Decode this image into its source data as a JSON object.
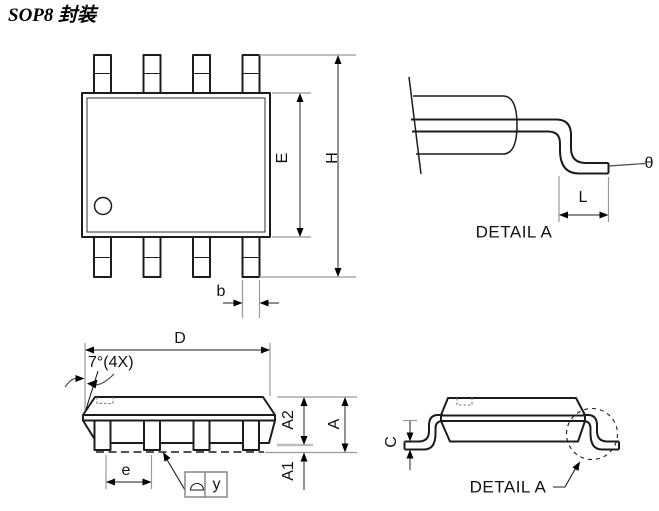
{
  "title": "SOP8 封装",
  "colors": {
    "line": "#1c1c1c",
    "extension": "#9a9a9a",
    "background": "#ffffff"
  },
  "views": {
    "top_view": {
      "dims": {
        "E": "E",
        "H": "H",
        "b": "b"
      }
    },
    "lead_detail": {
      "caption": "DETAIL A",
      "dims": {
        "L": "L",
        "theta": "θ"
      }
    },
    "front_view": {
      "dims": {
        "D": "D",
        "draft_angle": "7°(4X)",
        "A": "A",
        "A1": "A1",
        "A2": "A2",
        "e": "e"
      },
      "datum": {
        "flag": "y"
      }
    },
    "side_view": {
      "caption": "DETAIL A",
      "dims": {
        "C": "C"
      }
    }
  }
}
